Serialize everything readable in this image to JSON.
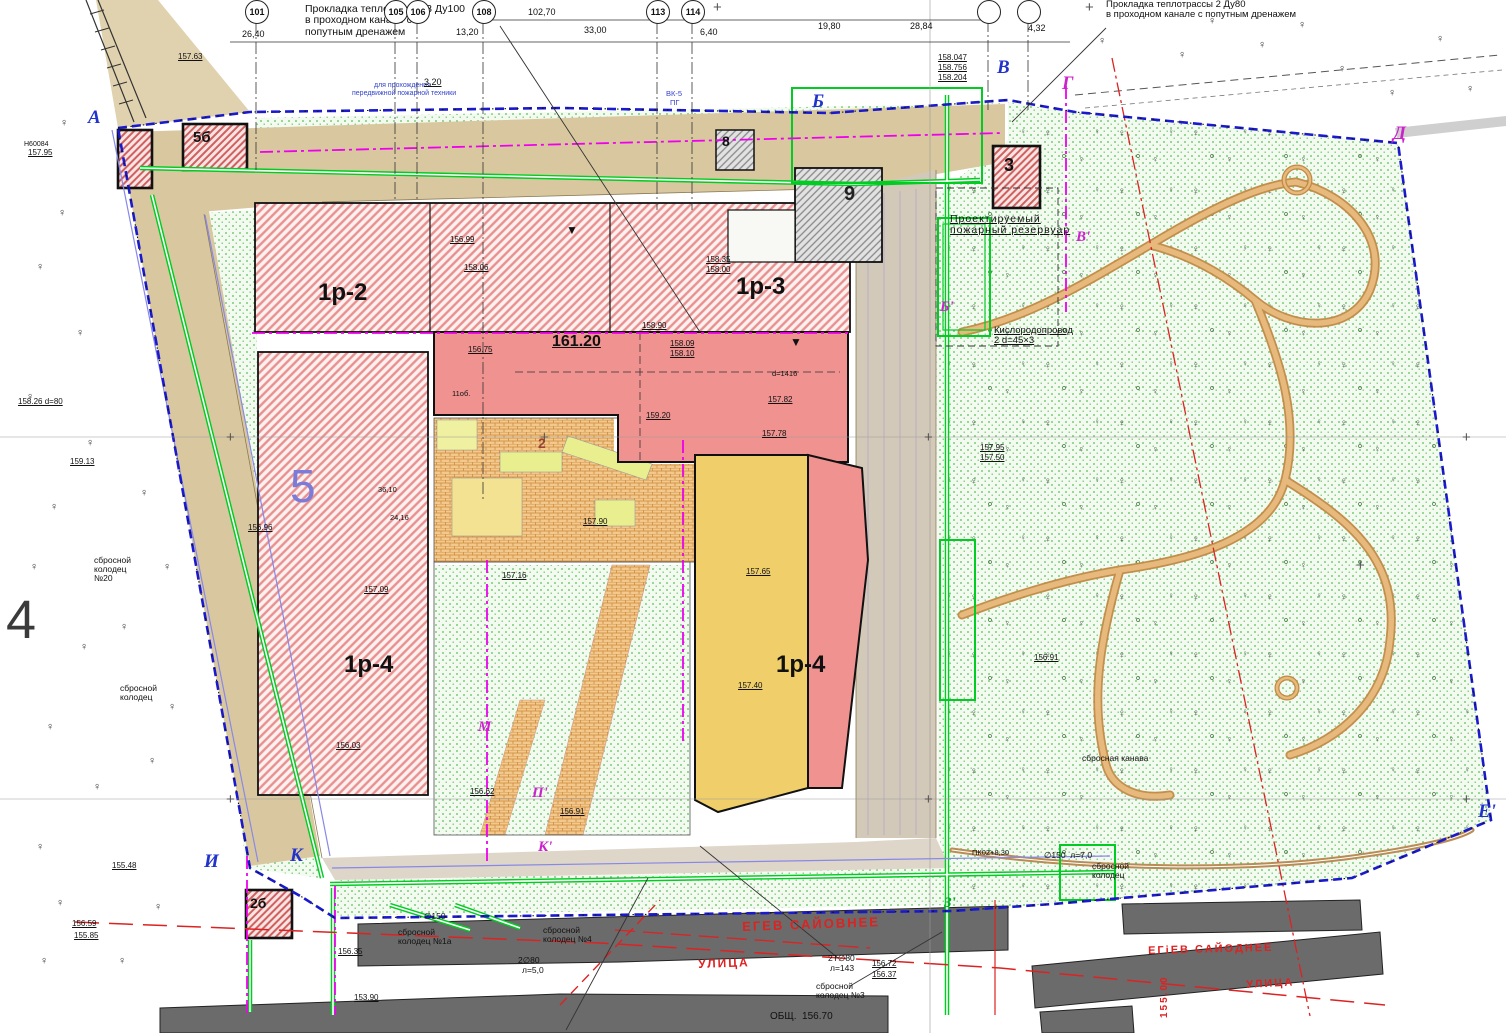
{
  "static_notes": {
    "note1": "Прокладка теплотрассы 3 Ду100\nв проходном канале с\nпопутным дренажем",
    "note2": "Прокладка теплотрассы 2 Ду80\nв проходном канале с попутным дренажем",
    "fire_reservoir": "Проектируемый\nпожарный резервуар",
    "oxygen_pipeline": "Кислородопровод\n2 d=45×3"
  },
  "colors": {
    "boundary_blue": "#1a1acc",
    "utility_green": "#00cc22",
    "red_line": "#dd2222",
    "magenta_line": "#ee00ee",
    "building_pink": "#ef9290",
    "road_tan": "#d9c89f",
    "park_green_dot": "#55c055",
    "existing_gray": "#6b6b6b"
  },
  "axis_bubbles": [
    {
      "n": "101",
      "x": 256
    },
    {
      "n": "105",
      "x": 395
    },
    {
      "n": "106",
      "x": 417
    },
    {
      "n": "108",
      "x": 483
    },
    {
      "n": "113",
      "x": 657
    },
    {
      "n": "114",
      "x": 692
    },
    {
      "n": "",
      "x": 988
    },
    {
      "n": "",
      "x": 1028
    }
  ],
  "dimensions": [
    {
      "t": "102,70",
      "x": 528,
      "y": 8
    },
    {
      "t": "26,40",
      "x": 242,
      "y": 30
    },
    {
      "t": "13,20",
      "x": 456,
      "y": 28
    },
    {
      "t": "33,00",
      "x": 584,
      "y": 26
    },
    {
      "t": "3,20",
      "x": 424,
      "y": 78,
      "u": true
    },
    {
      "t": "6,40",
      "x": 700,
      "y": 28
    },
    {
      "t": "19,80",
      "x": 818,
      "y": 22
    },
    {
      "t": "28,84",
      "x": 910,
      "y": 22
    },
    {
      "t": "4,32",
      "x": 1028,
      "y": 24
    }
  ],
  "section_markers": [
    {
      "t": "А",
      "x": 88,
      "y": 108
    },
    {
      "t": "Б",
      "x": 812,
      "y": 92
    },
    {
      "t": "В",
      "x": 997,
      "y": 58
    },
    {
      "t": "Г",
      "x": 1062,
      "y": 74,
      "c": "#cc22cc"
    },
    {
      "t": "Д",
      "x": 1393,
      "y": 124,
      "c": "#cc22cc"
    },
    {
      "t": "В'",
      "x": 1076,
      "y": 230,
      "c": "#cc22cc",
      "s": 15
    },
    {
      "t": "Б'",
      "x": 940,
      "y": 300,
      "c": "#cc22cc",
      "s": 15
    },
    {
      "t": "И",
      "x": 204,
      "y": 852
    },
    {
      "t": "К",
      "x": 290,
      "y": 846
    },
    {
      "t": "К'",
      "x": 538,
      "y": 840,
      "c": "#cc22cc",
      "s": 15
    },
    {
      "t": "М",
      "x": 478,
      "y": 720,
      "c": "#cc22cc",
      "s": 15
    },
    {
      "t": "П'",
      "x": 532,
      "y": 786,
      "c": "#cc22cc",
      "s": 15
    },
    {
      "t": "З'",
      "x": 944,
      "y": 896,
      "c": "#00aa22",
      "s": 15
    },
    {
      "t": "Е'",
      "x": 1478,
      "y": 802
    }
  ],
  "building_labels": [
    {
      "t": "5б",
      "x": 193,
      "y": 130,
      "s": 15
    },
    {
      "t": "8",
      "x": 722,
      "y": 134,
      "s": 14
    },
    {
      "t": "3",
      "x": 1004,
      "y": 156,
      "s": 18
    },
    {
      "t": "9",
      "x": 844,
      "y": 184,
      "s": 20,
      "c": "#222"
    },
    {
      "t": "1р-2",
      "x": 318,
      "y": 280,
      "s": 24
    },
    {
      "t": "1р-3",
      "x": 736,
      "y": 274,
      "s": 24
    },
    {
      "t": "161.20",
      "x": 552,
      "y": 334,
      "s": 16,
      "u": true
    },
    {
      "t": "5",
      "x": 290,
      "y": 462,
      "s": 46,
      "c": "#7b7bd8",
      "w": "400"
    },
    {
      "t": "1р-4",
      "x": 344,
      "y": 652,
      "s": 24
    },
    {
      "t": "1р-4",
      "x": 776,
      "y": 652,
      "s": 24
    },
    {
      "t": "2б",
      "x": 250,
      "y": 896,
      "s": 14
    },
    {
      "t": "4",
      "x": 6,
      "y": 592,
      "s": 54,
      "w": "300",
      "c": "#3a3a3a"
    },
    {
      "t": "2",
      "x": 538,
      "y": 436,
      "s": 14,
      "c": "#994433"
    }
  ],
  "elevation_marks": [
    {
      "t": "157.63",
      "x": 178,
      "y": 53
    },
    {
      "t": "157.95",
      "x": 28,
      "y": 149
    },
    {
      "t": "158.047",
      "x": 938,
      "y": 54
    },
    {
      "t": "158.756",
      "x": 938,
      "y": 64
    },
    {
      "t": "158.204",
      "x": 938,
      "y": 74
    },
    {
      "t": "158.26 d=80",
      "x": 18,
      "y": 398
    },
    {
      "t": "159.13",
      "x": 70,
      "y": 458
    },
    {
      "t": "156.99",
      "x": 450,
      "y": 236
    },
    {
      "t": "158.06",
      "x": 464,
      "y": 264
    },
    {
      "t": "158.35",
      "x": 706,
      "y": 256
    },
    {
      "t": "158.00",
      "x": 706,
      "y": 266
    },
    {
      "t": "158.90",
      "x": 642,
      "y": 322
    },
    {
      "t": "158.09",
      "x": 670,
      "y": 340
    },
    {
      "t": "158.10",
      "x": 670,
      "y": 350
    },
    {
      "t": "156.75",
      "x": 468,
      "y": 346
    },
    {
      "t": "159.20",
      "x": 646,
      "y": 412
    },
    {
      "t": "157.82",
      "x": 768,
      "y": 396
    },
    {
      "t": "157.78",
      "x": 762,
      "y": 430
    },
    {
      "t": "157.90",
      "x": 583,
      "y": 518
    },
    {
      "t": "157.16",
      "x": 502,
      "y": 572
    },
    {
      "t": "157.65",
      "x": 746,
      "y": 568
    },
    {
      "t": "157.40",
      "x": 738,
      "y": 682
    },
    {
      "t": "156.96",
      "x": 248,
      "y": 524
    },
    {
      "t": "157.09",
      "x": 364,
      "y": 586
    },
    {
      "t": "156.03",
      "x": 336,
      "y": 742
    },
    {
      "t": "156.62",
      "x": 470,
      "y": 788
    },
    {
      "t": "156.91",
      "x": 560,
      "y": 808
    },
    {
      "t": "155.48",
      "x": 112,
      "y": 862
    },
    {
      "t": "156.59",
      "x": 72,
      "y": 920
    },
    {
      "t": "155.85",
      "x": 74,
      "y": 932
    },
    {
      "t": "156.35",
      "x": 338,
      "y": 948
    },
    {
      "t": "153.90",
      "x": 354,
      "y": 994
    },
    {
      "t": "156.72",
      "x": 872,
      "y": 960
    },
    {
      "t": "156.37",
      "x": 872,
      "y": 971
    },
    {
      "t": "157.95",
      "x": 980,
      "y": 444
    },
    {
      "t": "157.50",
      "x": 980,
      "y": 454
    },
    {
      "t": "156.91",
      "x": 1034,
      "y": 654
    }
  ],
  "annotations": [
    {
      "t": "сбросной",
      "x": 94,
      "y": 556
    },
    {
      "t": "колодец",
      "x": 94,
      "y": 565
    },
    {
      "t": "№20",
      "x": 94,
      "y": 574
    },
    {
      "t": "сбросной",
      "x": 120,
      "y": 684
    },
    {
      "t": "колодец",
      "x": 120,
      "y": 693
    },
    {
      "t": "∅150",
      "x": 424,
      "y": 912
    },
    {
      "t": "сбросной",
      "x": 398,
      "y": 928
    },
    {
      "t": "колодец №1а",
      "x": 398,
      "y": 937
    },
    {
      "t": "сбросной",
      "x": 543,
      "y": 926
    },
    {
      "t": "колодец №4",
      "x": 543,
      "y": 935
    },
    {
      "t": "сбросной",
      "x": 816,
      "y": 982
    },
    {
      "t": "колодец №3",
      "x": 816,
      "y": 991
    },
    {
      "t": "2Т∅80",
      "x": 828,
      "y": 954
    },
    {
      "t": "л=143",
      "x": 830,
      "y": 964
    },
    {
      "t": "2∅80",
      "x": 518,
      "y": 956
    },
    {
      "t": "л=5,0",
      "x": 522,
      "y": 966
    },
    {
      "t": "∅150  л=7,0",
      "x": 1044,
      "y": 851
    },
    {
      "t": "сбросной",
      "x": 1092,
      "y": 862
    },
    {
      "t": "колодец",
      "x": 1092,
      "y": 871
    },
    {
      "t": "ПК02+8,30",
      "x": 972,
      "y": 849,
      "s": 7.5
    },
    {
      "t": "сбросная канава",
      "x": 1082,
      "y": 754
    },
    {
      "t": "ОБЩ.  156.70",
      "x": 770,
      "y": 1012,
      "s": 10
    },
    {
      "t": "Н60084",
      "x": 24,
      "y": 141,
      "s": 7
    },
    {
      "t": "для прохождения",
      "x": 374,
      "y": 82,
      "s": 7,
      "c": "#3344cc"
    },
    {
      "t": "передвижной пожарной техники",
      "x": 352,
      "y": 90,
      "s": 7,
      "c": "#3344cc"
    },
    {
      "t": "ВК-5",
      "x": 666,
      "y": 90,
      "s": 7.5,
      "c": "#3344cc"
    },
    {
      "t": "ПГ",
      "x": 670,
      "y": 99,
      "s": 7.5,
      "c": "#3344cc"
    },
    {
      "t": "11об.",
      "x": 452,
      "y": 390,
      "s": 7.5
    },
    {
      "t": "d=1416",
      "x": 772,
      "y": 370,
      "s": 7.5
    },
    {
      "t": "36,10",
      "x": 378,
      "y": 486,
      "s": 7.5
    },
    {
      "t": "24,16",
      "x": 390,
      "y": 514,
      "s": 7.5
    },
    {
      "t": "▼",
      "x": 790,
      "y": 336,
      "s": 12
    },
    {
      "t": "▼",
      "x": 566,
      "y": 224,
      "s": 12
    }
  ],
  "street_names": [
    {
      "t": "ЕГЕВ САЙОВНЕЕ",
      "x": 742,
      "y": 920,
      "s": 13,
      "r": -2
    },
    {
      "t": "ЕГіЕВ САЙОДНЕЕ",
      "x": 1148,
      "y": 946,
      "s": 11,
      "r": -1.5
    },
    {
      "t": "УЛИЦА",
      "x": 698,
      "y": 958,
      "s": 12,
      "r": -2
    },
    {
      "t": "УЛИЦА",
      "x": 1246,
      "y": 980,
      "s": 11,
      "r": -3
    },
    {
      "t": "155.00",
      "x": 1160,
      "y": 1018,
      "s": 10,
      "r": -90
    }
  ],
  "trees": [
    [
      58,
      208
    ],
    [
      36,
      262
    ],
    [
      76,
      328
    ],
    [
      26,
      392
    ],
    [
      86,
      438
    ],
    [
      50,
      502
    ],
    [
      30,
      562
    ],
    [
      80,
      642
    ],
    [
      46,
      722
    ],
    [
      93,
      782
    ],
    [
      36,
      842
    ],
    [
      140,
      488
    ],
    [
      163,
      562
    ],
    [
      120,
      622
    ],
    [
      168,
      702
    ],
    [
      148,
      756
    ],
    [
      60,
      118
    ],
    [
      1098,
      36
    ],
    [
      1178,
      50
    ],
    [
      1258,
      40
    ],
    [
      1338,
      64
    ],
    [
      1436,
      34
    ],
    [
      1466,
      84
    ],
    [
      1208,
      16
    ],
    [
      1298,
      20
    ],
    [
      1388,
      88
    ],
    [
      56,
      898
    ],
    [
      40,
      956
    ],
    [
      118,
      956
    ],
    [
      154,
      902
    ]
  ],
  "survey_crosses": [
    [
      713,
      0
    ],
    [
      1085,
      0
    ],
    [
      226,
      430
    ],
    [
      540,
      430
    ],
    [
      924,
      430
    ],
    [
      1462,
      430
    ],
    [
      226,
      792
    ],
    [
      924,
      792
    ],
    [
      1356,
      558
    ],
    [
      1462,
      792
    ]
  ]
}
